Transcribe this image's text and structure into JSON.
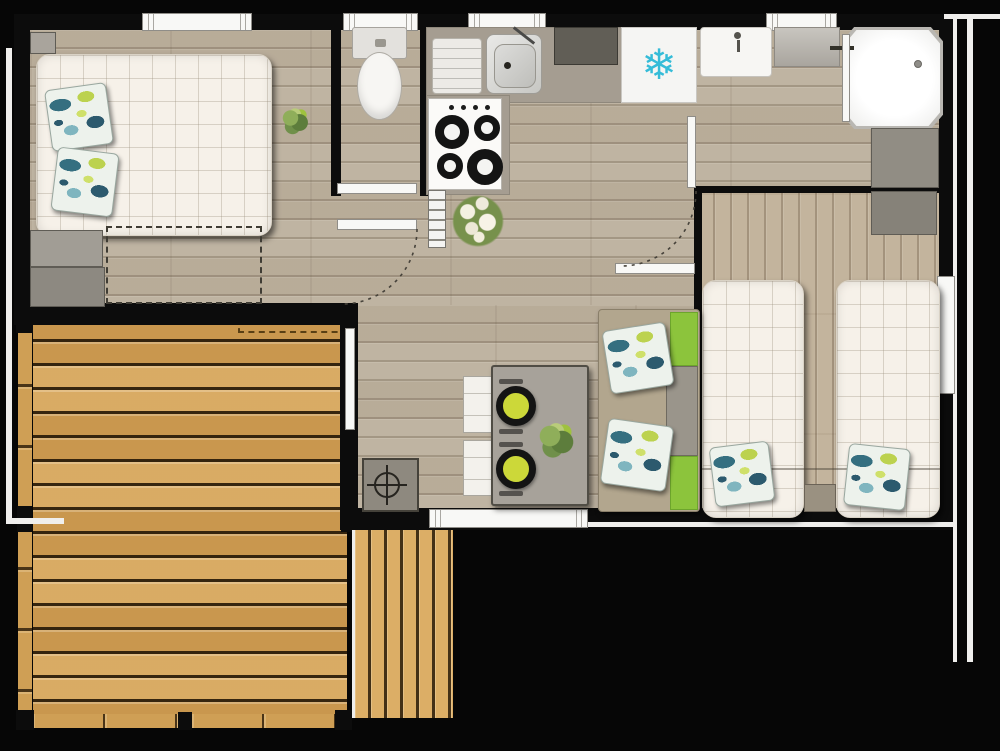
{
  "meta": {
    "kind": "floor-plan",
    "description": "Top-down 2D architectural plan of a mobile home / chalet with an attached wooden deck, rendered on a black background with no text labels"
  },
  "icons": {
    "snowflake_glyph": "❄",
    "drain_symbol": "circle-crosshair",
    "door_swing": "dashed-quarter-arc"
  },
  "colors": {
    "background": "#060606",
    "wall": "#0c0c0c",
    "interior_wood": "#bfb4a2",
    "deck_wood": "#d2a157",
    "step_wood": "#dcae66",
    "mattress": "#f6f1e9",
    "accent_green": "#8cc43c",
    "counter_grey": "#a59d91",
    "table_grey": "#a7a29a",
    "plate_yellow": "#ccd839",
    "snowflake_cyan": "#35bcd8",
    "outline_white": "#f0efed"
  },
  "rooms": [
    {
      "name": "master-bedroom",
      "furniture": [
        "double-bed",
        "two-pattern-pillows",
        "corner-shelf",
        "wardrobe-blocks",
        "dashed-storage-zone",
        "floor-plant"
      ]
    },
    {
      "name": "wc",
      "furniture": [
        "toilet",
        "sliding-door"
      ]
    },
    {
      "name": "kitchen",
      "furniture": [
        "l-counter",
        "drainboard",
        "sink-with-faucet",
        "dark-tray",
        "fridge-with-snowflake",
        "four-burner-hob",
        "ladder-radiator",
        "flower-bouquet"
      ]
    },
    {
      "name": "bathroom",
      "furniture": [
        "washbasin",
        "grey-shelf",
        "corner-shower-with-drain",
        "hinged-door"
      ]
    },
    {
      "name": "twin-bedroom",
      "furniture": [
        "single-bed-left",
        "single-bed-right",
        "two-pattern-pillows",
        "nightstand",
        "two-wardrobes",
        "side-window"
      ]
    },
    {
      "name": "living-dining",
      "furniture": [
        "sofa-with-green-backrests",
        "two-sofa-pillows",
        "dining-table",
        "two-white-chairs",
        "two-place-settings",
        "table-plant",
        "technical-box-with-drain-symbol",
        "sliding-entry-door"
      ]
    },
    {
      "name": "deck",
      "furniture": [
        "horizontal-plank-decking",
        "railing-posts",
        "railing-rails",
        "white-gate-strip",
        "dashed-step-marker",
        "vertical-plank-steps"
      ]
    }
  ],
  "windows": {
    "top_wall": 4,
    "right_wall": 1,
    "deck_wall": 1
  }
}
